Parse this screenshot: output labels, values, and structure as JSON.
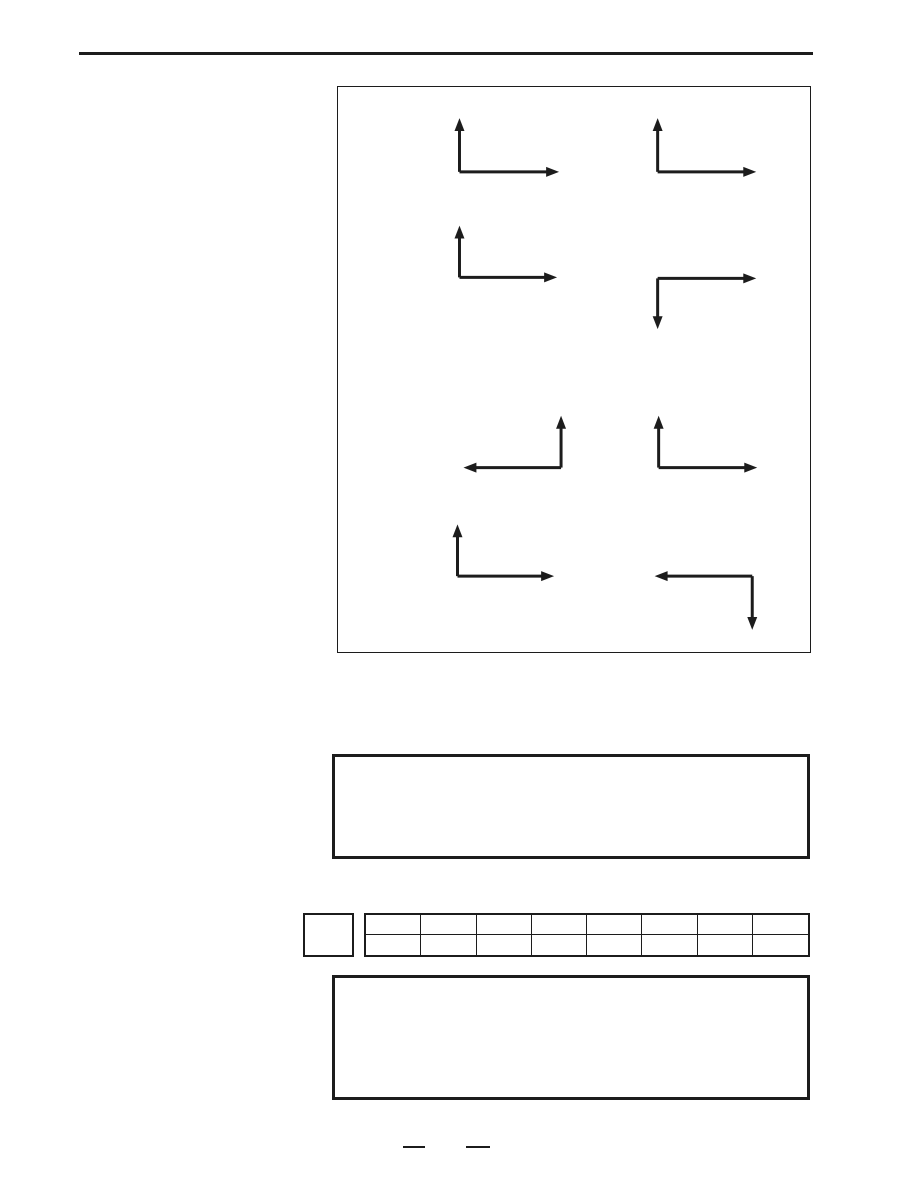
{
  "page": {
    "kind": "document-worksheet-page",
    "background_color": "#ffffff",
    "ink_color": "#1c1c1c",
    "visible_text": ""
  },
  "arrow_diagram": {
    "figure_count": 8,
    "stroke_width": 3,
    "arrowhead_length": 13,
    "arrowhead_half_width": 5,
    "figures": [
      {
        "direction": "up-right",
        "corner": [
          459,
          171
        ],
        "arms": [
          {
            "dir": "up",
            "len": 54
          },
          {
            "dir": "right",
            "len": 100
          }
        ]
      },
      {
        "direction": "up-right",
        "corner": [
          658,
          171
        ],
        "arms": [
          {
            "dir": "up",
            "len": 54
          },
          {
            "dir": "right",
            "len": 99
          }
        ]
      },
      {
        "direction": "up-right",
        "corner": [
          459,
          277
        ],
        "arms": [
          {
            "dir": "up",
            "len": 52
          },
          {
            "dir": "right",
            "len": 98
          }
        ]
      },
      {
        "direction": "right-down",
        "corner": [
          658,
          278
        ],
        "arms": [
          {
            "dir": "right",
            "len": 99
          },
          {
            "dir": "down",
            "len": 51
          }
        ]
      },
      {
        "direction": "up-left",
        "corner": [
          561,
          468
        ],
        "arms": [
          {
            "dir": "up",
            "len": 52
          },
          {
            "dir": "left",
            "len": 98
          }
        ]
      },
      {
        "direction": "up-right",
        "corner": [
          659,
          468
        ],
        "arms": [
          {
            "dir": "up",
            "len": 52
          },
          {
            "dir": "right",
            "len": 99
          }
        ]
      },
      {
        "direction": "up-right",
        "corner": [
          457,
          577
        ],
        "arms": [
          {
            "dir": "up",
            "len": 52
          },
          {
            "dir": "right",
            "len": 97
          }
        ]
      },
      {
        "direction": "left-down",
        "corner": [
          753,
          577
        ],
        "arms": [
          {
            "dir": "left",
            "len": 98
          },
          {
            "dir": "down",
            "len": 54
          }
        ]
      }
    ]
  },
  "answer_boxes": {
    "middle_box_content": "",
    "bottom_box_content": ""
  },
  "table": {
    "rows": 2,
    "columns": 8,
    "all_cells_empty": true
  },
  "label_square_content": "",
  "footer": {
    "blank_line_count": 2
  }
}
